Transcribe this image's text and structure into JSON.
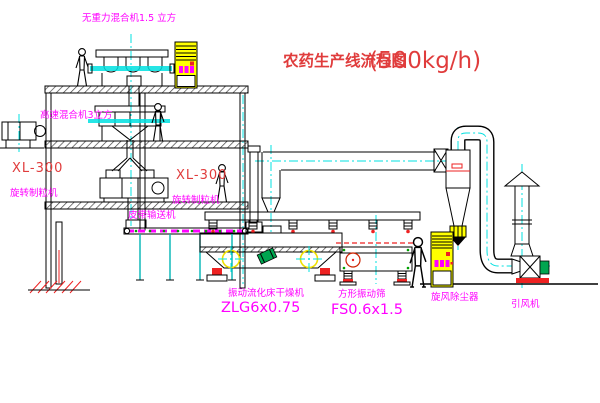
{
  "title": {
    "name": "农药生产线流程图",
    "capacity": "(500kg/h)"
  },
  "labels": {
    "top_mixer": "无重力混合机1.5 立方",
    "high_speed_mixer": "高速混合机3立方",
    "left_granulator_model": "XL-300",
    "left_granulator": "旋转制粒机",
    "mid_granulator_model": "XL-300",
    "mid_granulator": "旋转制粒机",
    "belt_conveyor": "皮带输送机",
    "fluid_bed_dryer": "振动流化床干燥机",
    "fluid_bed_dryer_model": "ZLG6x0.75",
    "square_sifter": "方形振动筛",
    "square_sifter_model": "FS0.6x1.5",
    "cyclone": "旋风除尘器",
    "induced_fan": "引风机"
  },
  "colors": {
    "label_magenta": "#ff00ff",
    "model_red": "#e03c3c",
    "accent_red": "#ee2222",
    "centerline_cyan": "#00e0e0",
    "cabinet_yellow": "#ffff00",
    "crosshair_yellow": "#f0e000",
    "motor_green": "#00a550",
    "dot_green": "#00a000"
  }
}
